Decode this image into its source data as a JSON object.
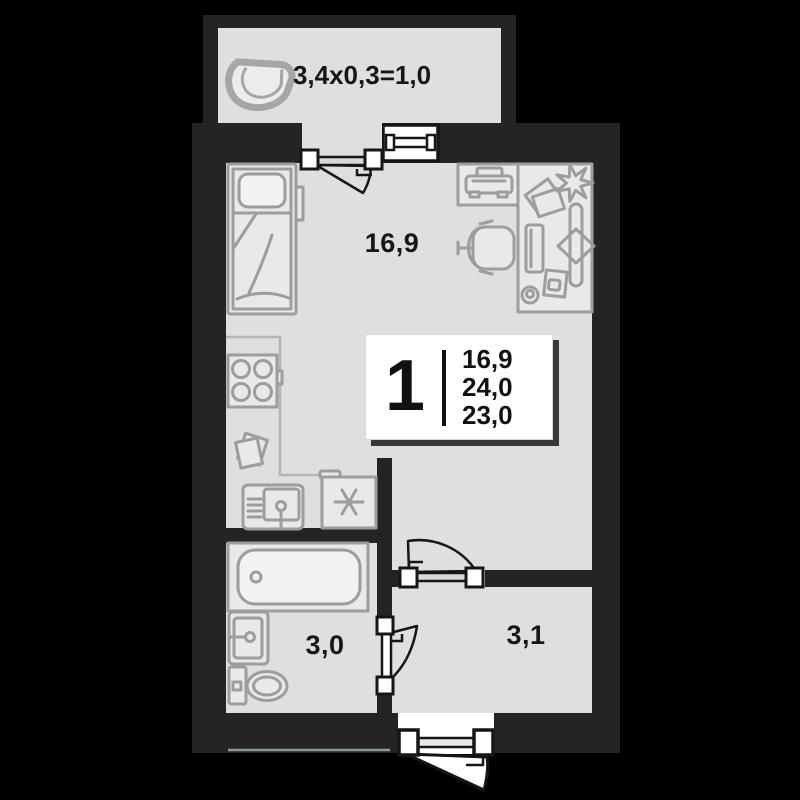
{
  "colors": {
    "bg": "#000000",
    "wall": "#242424",
    "floor": "#dfdfdf",
    "furn": "#e9e9e9",
    "furn2": "#f2f2f2",
    "line": "#9d9d9d",
    "ink": "#161616",
    "white": "#ffffff",
    "card-shadow": "#383838",
    "slab-line": "#b9cdd4"
  },
  "plan": {
    "balcony": {
      "label": "3,4x0,3=1,0"
    },
    "rooms": [
      {
        "name": "living-room",
        "area_label": "16,9"
      },
      {
        "name": "bathroom",
        "area_label": "3,0"
      },
      {
        "name": "hallway",
        "area_label": "3,1"
      }
    ],
    "info_card": {
      "rooms_count": "1",
      "living_area": "16,9",
      "total_area": "24,0",
      "other_area": "23,0"
    },
    "furniture_icons": [
      "balcony-chair-icon",
      "bed-icon",
      "bedside-shelf-icon",
      "printer-icon",
      "desk-icon",
      "books-icon",
      "plant-icon",
      "monitor-icon",
      "decor-board-icon",
      "tablet-icon",
      "mouse-icon",
      "chair-icon",
      "kitchen-counter",
      "stove-icon",
      "cutting-boards-icon",
      "kitchen-sink-icon",
      "fridge-icon",
      "bathtub-icon",
      "bathroom-sink-icon",
      "toilet-icon",
      "window-icon",
      "balcony-door",
      "hall-door",
      "bathroom-door",
      "entrance-door"
    ]
  }
}
